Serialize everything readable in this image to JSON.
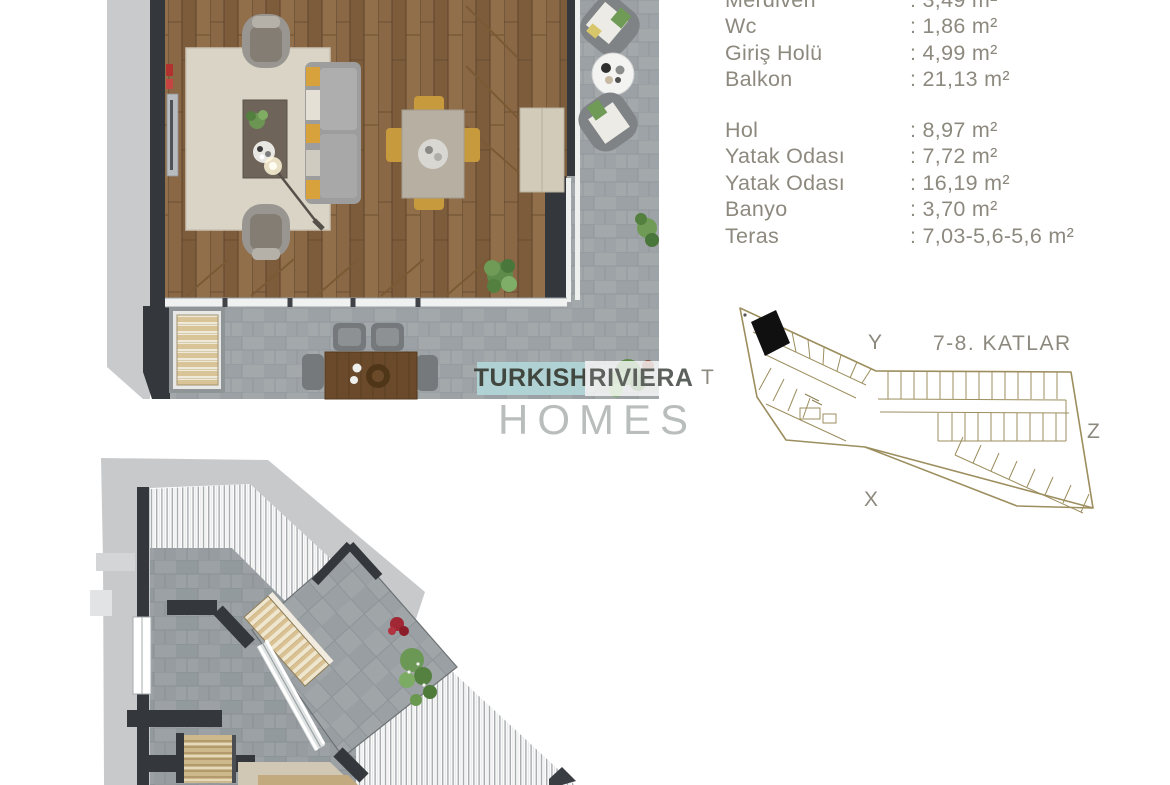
{
  "area_table": {
    "text_color": "#8d897f",
    "groups": [
      {
        "rows": [
          {
            "label": "Merdiven",
            "value": ": 3,49 m²"
          },
          {
            "label": "Wc",
            "value": ": 1,86 m²"
          },
          {
            "label": "Giriş Holü",
            "value": ": 4,99 m²"
          },
          {
            "label": "Balkon",
            "value": ": 21,13 m²"
          }
        ]
      },
      {
        "rows": [
          {
            "label": "Hol",
            "value": ": 8,97 m²"
          },
          {
            "label": "Yatak Odası",
            "value": ": 7,72 m²"
          },
          {
            "label": "Yatak Odası",
            "value": ": 16,19 m²"
          },
          {
            "label": "Banyo",
            "value": ": 3,70 m²"
          },
          {
            "label": "Teras",
            "value": ": 7,03-5,6-5,6 m²"
          }
        ]
      }
    ]
  },
  "key_plan": {
    "title": "7-8. KATLAR",
    "axes": {
      "top": "Y",
      "left": "T",
      "right": "Z",
      "bottom": "X"
    },
    "outline_color": "#9c8e5e",
    "highlight_color": "#101010"
  },
  "watermark": {
    "word1": "TURKISH",
    "word2": "RIVIERA",
    "word3": "HOMES",
    "teal_color": "#b0d5d7"
  }
}
